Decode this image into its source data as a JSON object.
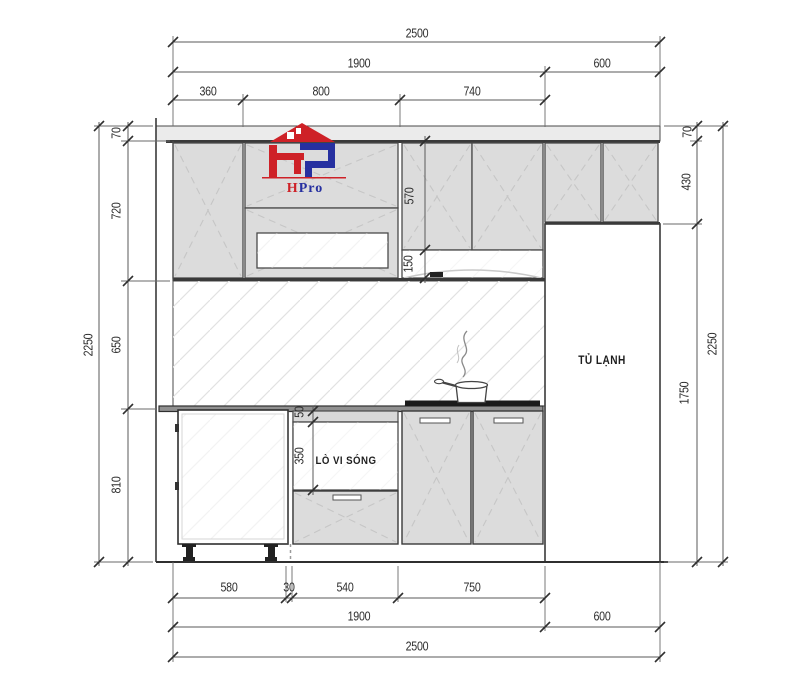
{
  "labels": {
    "fridge": "TỦ LẠNH",
    "microwave": "LÒ VI SÓNG"
  },
  "logo": {
    "h": "H",
    "pro": "Pro"
  },
  "dimensions": {
    "top": [
      "2500",
      "1900",
      "600",
      "360",
      "800",
      "740"
    ],
    "bottom": [
      "580",
      "30",
      "540",
      "750",
      "1900",
      "600",
      "2500"
    ],
    "left": [
      "70",
      "720",
      "650",
      "810",
      "2250"
    ],
    "right": [
      "70",
      "430",
      "1750",
      "2250"
    ],
    "internal": [
      "570",
      "150",
      "50",
      "350"
    ]
  },
  "colors": {
    "logo_red": "#ce2127",
    "logo_blue": "#2630a0",
    "cabinet_fill": "#dcdcdc",
    "strip_fill": "#ebebeb",
    "line": "#4a4a4a",
    "dash": "#c6c6c6",
    "hatch": "#e2e2e2",
    "cooktop": "#1b1b1b"
  }
}
